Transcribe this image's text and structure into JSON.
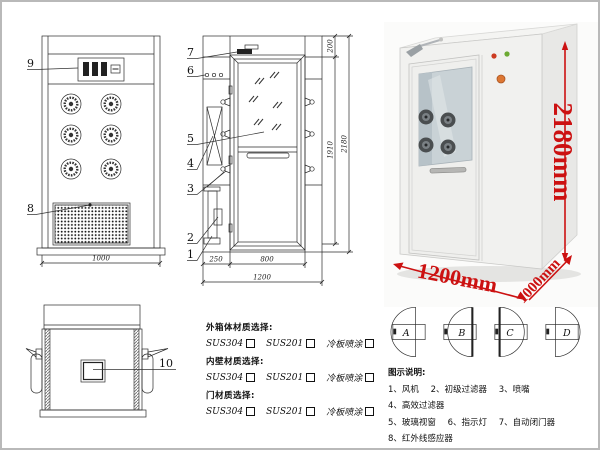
{
  "front_view": {
    "callout_9": "9",
    "callout_8": "8",
    "dim_width": "1000"
  },
  "door_view": {
    "callout_7": "7",
    "callout_6": "6",
    "callout_5": "5",
    "callout_4": "4",
    "callout_3": "3",
    "callout_2": "2",
    "callout_1": "1",
    "dim_top": "200",
    "dim_door_height": "1910",
    "dim_total_height": "2180",
    "dim_left": "250",
    "dim_door_width": "800",
    "dim_total_width": "1200"
  },
  "top_view": {
    "callout_10": "10"
  },
  "photo": {
    "dim_height": "2180mm",
    "dim_width": "1200mm",
    "dim_depth": "1000mm",
    "dim_color": "#cc1111"
  },
  "materials": {
    "sections": [
      {
        "label": "外箱体材质选择:",
        "options": [
          "SUS304",
          "SUS201",
          "冷板喷涂"
        ]
      },
      {
        "label": "内壁材质选择:",
        "options": [
          "SUS304",
          "SUS201",
          "冷板喷涂"
        ]
      },
      {
        "label": "门材质选择:",
        "options": [
          "SUS304",
          "SUS201",
          "冷板喷涂"
        ]
      }
    ]
  },
  "door_swing": {
    "labels": [
      "A",
      "B",
      "C",
      "D"
    ]
  },
  "legend": {
    "title": "图示说明:",
    "items": [
      "1、风机",
      "2、初级过滤器",
      "3、喷嘴",
      "4、高效过滤器",
      "5、玻璃视窗",
      "6、指示灯",
      "7、自动闭门器",
      "8、红外线感应器",
      "9、控制面板",
      "10、照明灯"
    ]
  }
}
